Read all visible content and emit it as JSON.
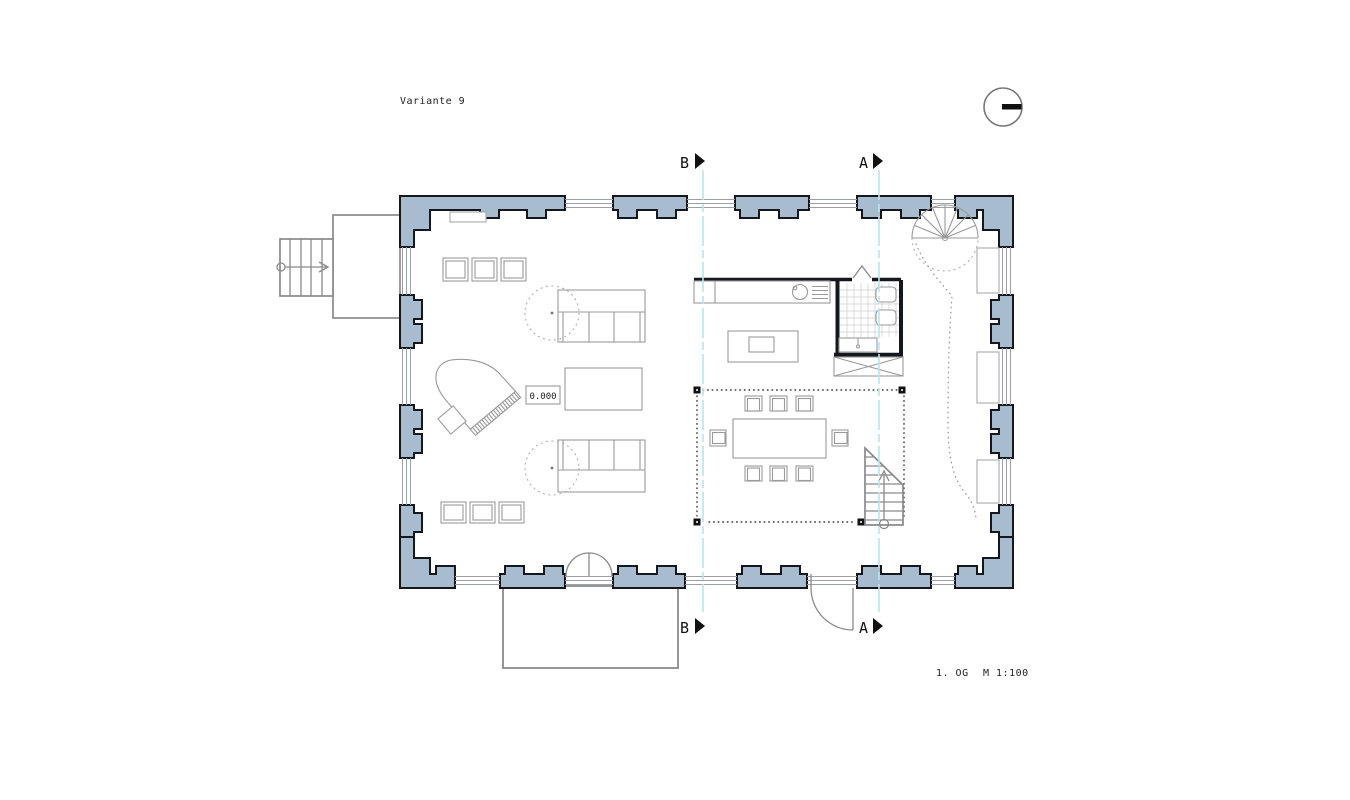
{
  "title": {
    "label": "Variante 9"
  },
  "footer": {
    "floor_label": "1. OG",
    "scale_label": "M 1:100"
  },
  "level_marker": {
    "value": "0.000"
  },
  "section_markers": {
    "b_top": "B",
    "a_top": "A",
    "b_bottom": "B",
    "a_bottom": "A"
  },
  "icons": {
    "north_indicator": "circle-with-bar"
  },
  "colors": {
    "wall_fill": "#a7bccf",
    "wall_outline": "#14181c",
    "section_line": "#b5e6ef",
    "furniture_line": "#9a9a9a",
    "exterior_line": "#8a8a8a",
    "column_fill": "#111111",
    "background": "#ffffff"
  }
}
